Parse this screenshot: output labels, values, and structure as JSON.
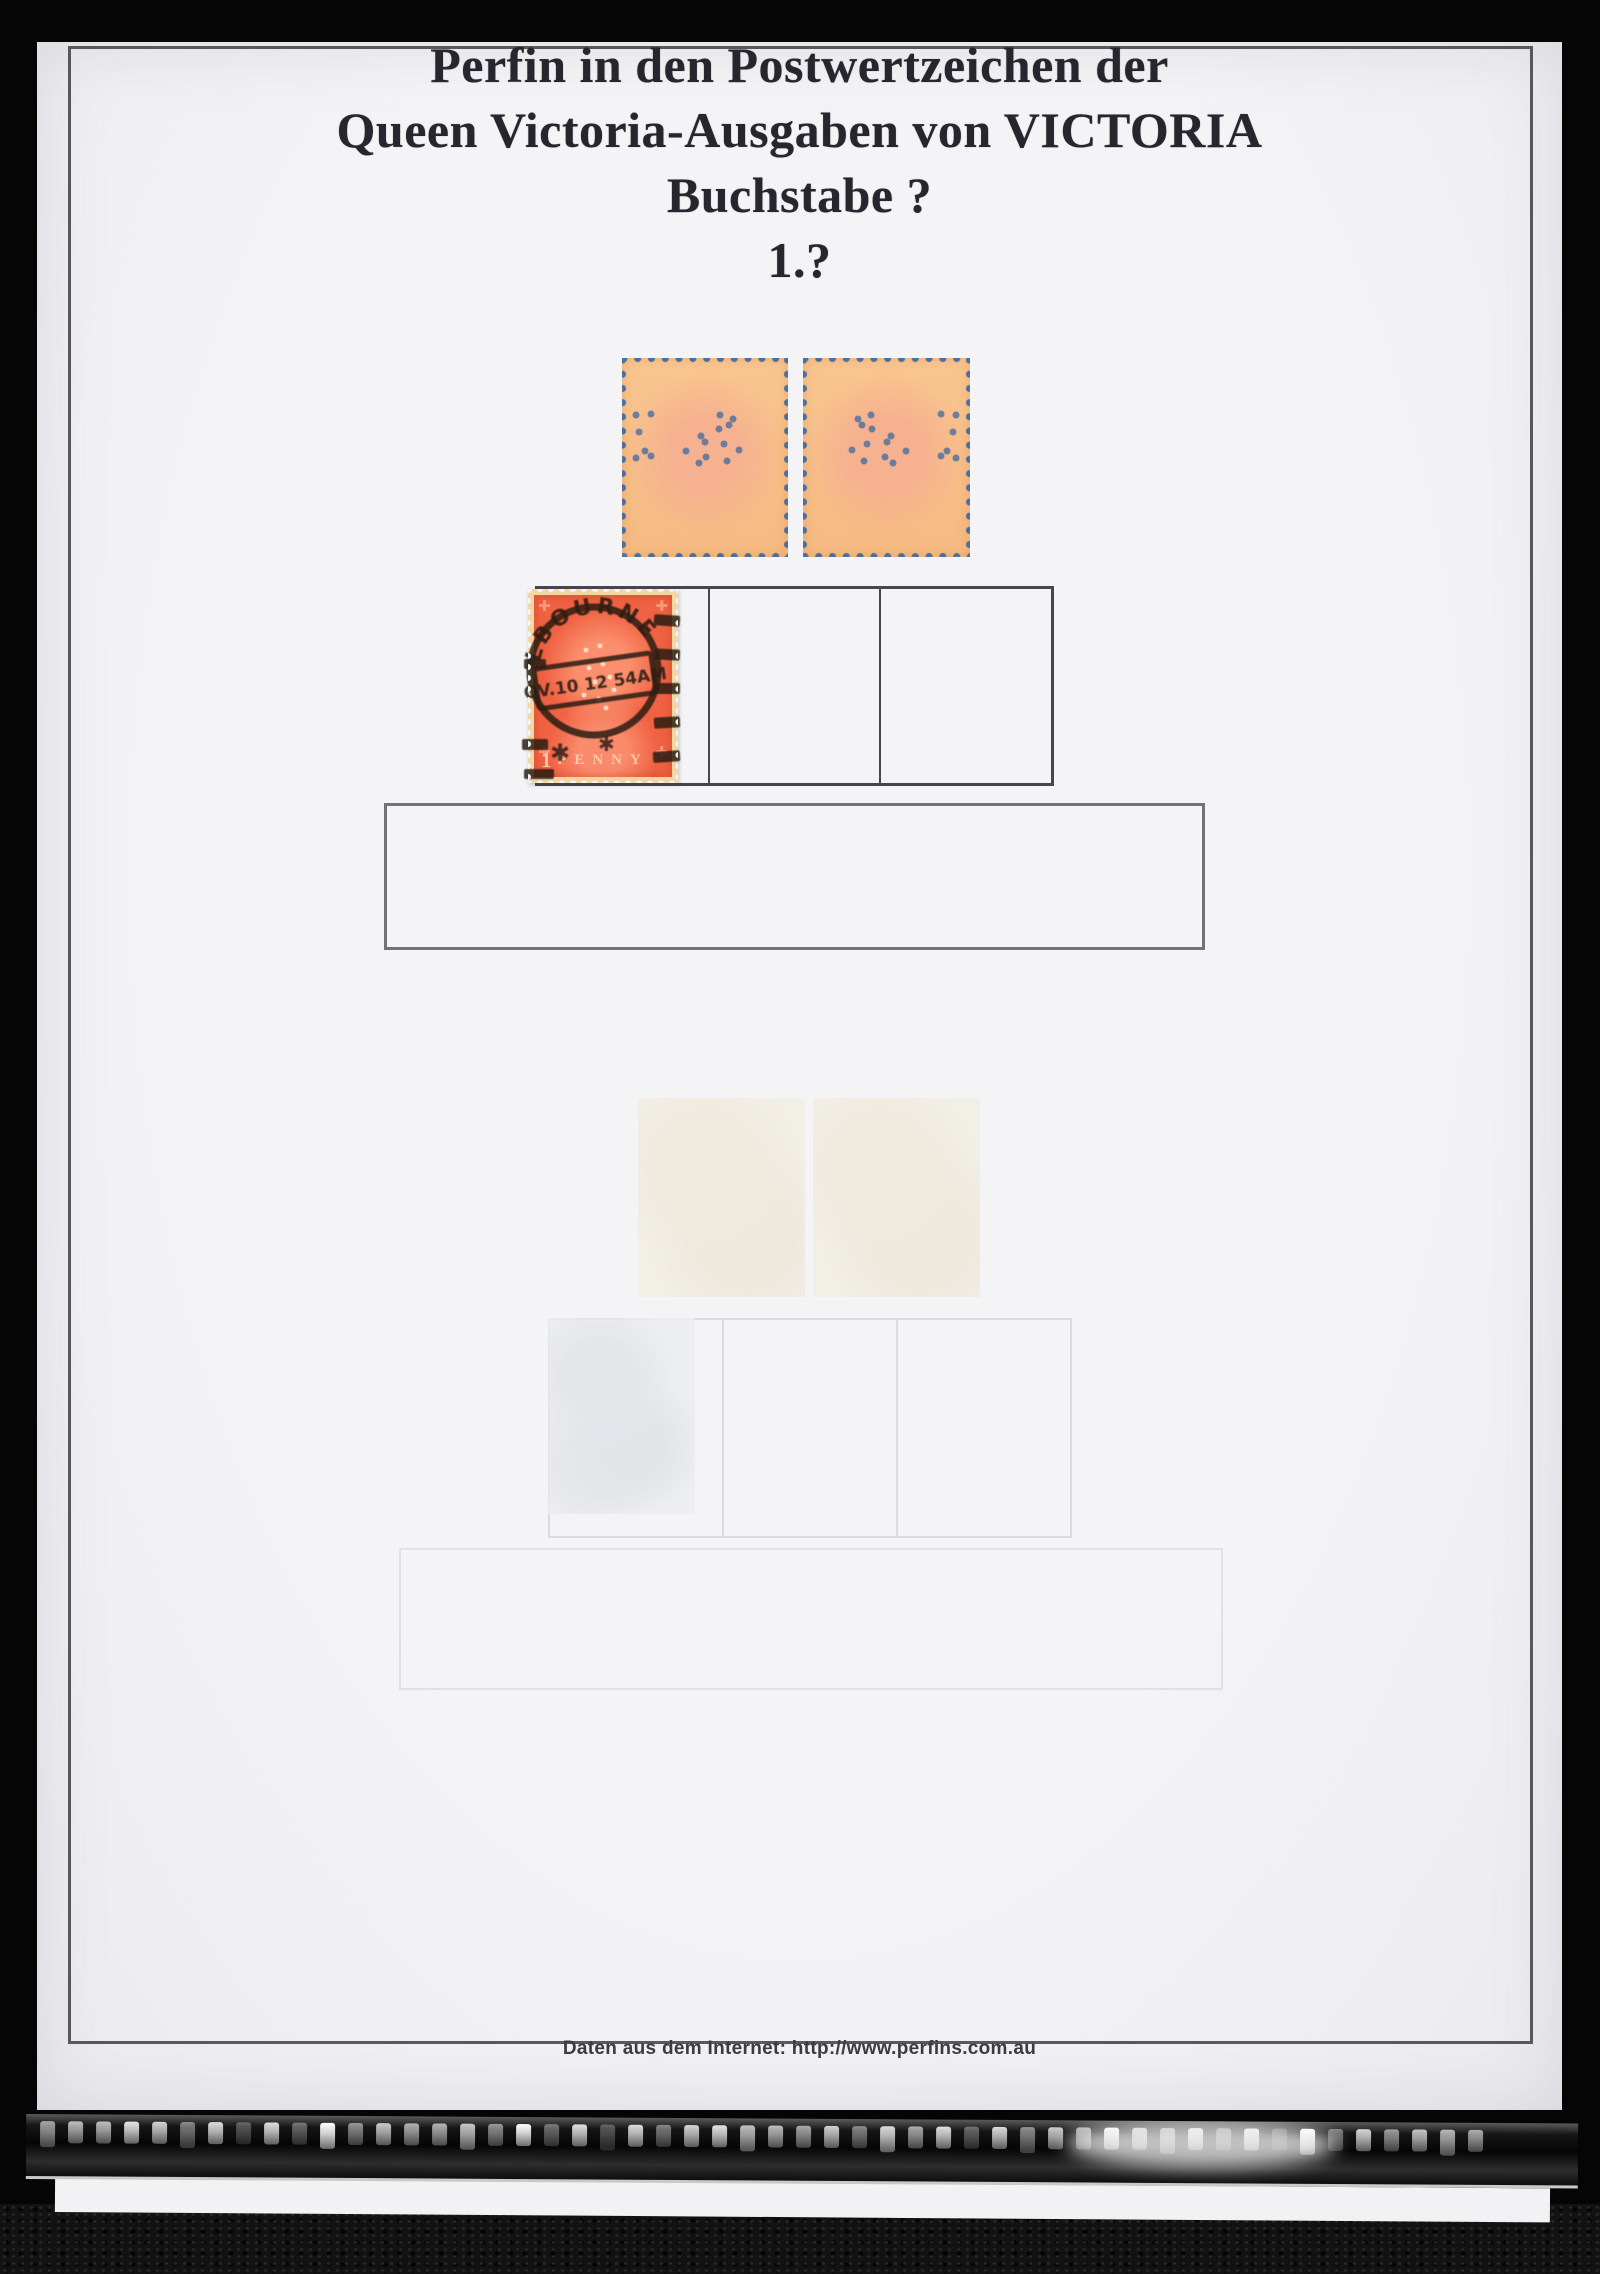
{
  "scan": {
    "title_lines": [
      "Perfin in den Postwertzeichen der",
      "Queen Victoria-Ausgaben von VICTORIA",
      "Buchstabe ?",
      "1.?"
    ],
    "footer_text": "Daten aus dem Internet: http://www.perfins.com.au"
  },
  "stamps": {
    "mounted_pair": {
      "description": "Two orange Queen Victoria stamps shown from the reverse with perfin hole patterns, in blue-backed mounts",
      "left_perfin_dots": [
        [
          8.4,
          28.6
        ],
        [
          17.5,
          28.1
        ],
        [
          10.2,
          37.2
        ],
        [
          13.9,
          46.7
        ],
        [
          8.4,
          50.3
        ],
        [
          17.5,
          49.2
        ],
        [
          59,
          28.6
        ],
        [
          66.9,
          30.7
        ],
        [
          58.4,
          35.7
        ],
        [
          64.5,
          33.7
        ],
        [
          47.6,
          39.2
        ],
        [
          50,
          42.2
        ],
        [
          38.6,
          46.7
        ],
        [
          50.6,
          49.7
        ],
        [
          46.4,
          52.8
        ],
        [
          61.4,
          43.2
        ],
        [
          70.5,
          46.2
        ],
        [
          63.3,
          51.8
        ]
      ],
      "right_perfin_dots": [
        [
          91.6,
          28.6
        ],
        [
          82.5,
          28.1
        ],
        [
          89.8,
          37.2
        ],
        [
          86.1,
          46.7
        ],
        [
          91.6,
          50.3
        ],
        [
          82.5,
          49.2
        ],
        [
          41,
          28.6
        ],
        [
          33.1,
          30.7
        ],
        [
          41.6,
          35.7
        ],
        [
          35.5,
          33.7
        ],
        [
          52.4,
          39.2
        ],
        [
          50,
          42.2
        ],
        [
          61.4,
          46.7
        ],
        [
          49.4,
          49.7
        ],
        [
          53.6,
          52.8
        ],
        [
          38.6,
          43.2
        ],
        [
          29.5,
          46.2
        ],
        [
          36.7,
          51.8
        ]
      ]
    },
    "postmarked": {
      "description": "Victoria One Penny orange-red stamp with heavy Melbourne duplex postmark",
      "numeral": "1",
      "value_label": "PENNY",
      "postmark_arc_text": "LBOURNE",
      "postmark_date_text": "OV.10 12 54AM",
      "ornament_glyph": "✚",
      "star_glyph": "✱",
      "perfin_dots": [
        [
          38,
          30
        ],
        [
          48,
          28
        ],
        [
          40,
          40
        ],
        [
          50,
          38
        ],
        [
          44,
          48
        ],
        [
          55,
          45
        ],
        [
          36,
          55
        ],
        [
          47,
          57
        ],
        [
          58,
          52
        ],
        [
          52,
          62
        ]
      ]
    }
  },
  "film_strip": {
    "glint_count": 52
  },
  "colors": {
    "page_bg": "#f4f4f6",
    "title_ink": "#26262e",
    "frame_line": "#47474d",
    "box_line": "#46464c",
    "perf_mount_blue": "#4d6f9f",
    "stamp_red": "#ef6243",
    "perf_cream": "#f2d7a3",
    "postmark_ink": "#241a10"
  }
}
